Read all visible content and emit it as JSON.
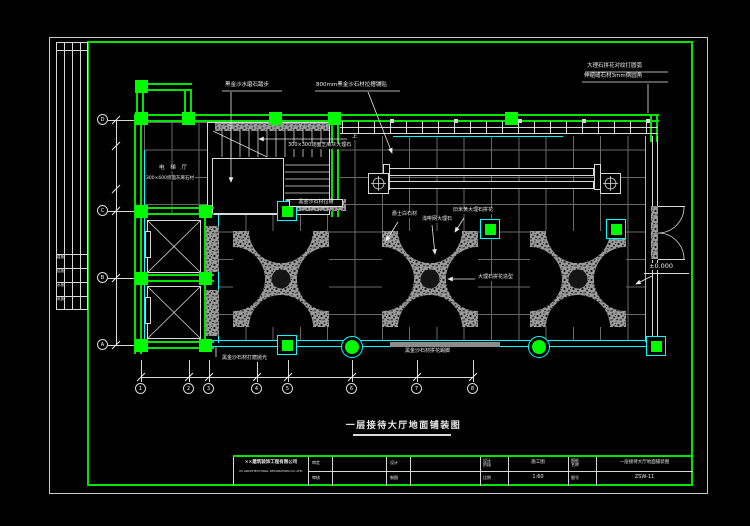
{
  "plan": {
    "title": "一层接待大厅地面铺装图",
    "notes": {
      "step": "黑金沙水磨石踏步",
      "base": "800mm黑金沙石材拉槽铺贴",
      "corner1": "大理石拼花对纹打圆弧",
      "corner2": "伸缩缝石材3mm倒圆角",
      "stair_stone": "300×300烧面芝麻灰大理石",
      "up": "上",
      "elev_hall": "电 梯 厅",
      "elev_floor": "300×600烧面灰麻石材",
      "groove": "黑金沙石材拉槽",
      "white_stone": "爵士白石材",
      "coffee_stone": "浅啡网大理石",
      "beige_stone": "旧米黄大理石拼花",
      "medallion": "大理石拼花造型",
      "polish": "黑金沙石材打磨抛光",
      "skirt": "黑金沙石材拼花踢脚",
      "level": "±0.000"
    },
    "grid": {
      "rows": [
        "D",
        "C",
        "B",
        "A"
      ],
      "cols": [
        "1",
        "2",
        "3",
        "4",
        "5",
        "6",
        "7",
        "8"
      ]
    }
  },
  "titleblock": {
    "company1": "××建筑装饰工程有限公司",
    "company2": "XX ARCHITECTURAL DECORATION CO.,LTD.",
    "l_shending": "审定",
    "l_shenhe": "审核",
    "l_sheji": "设计",
    "l_zhitu": "制图",
    "l_stage": "设计阶段",
    "v_stage": "施工图",
    "l_scale": "比例",
    "v_scale": "1:60",
    "l_name": "图纸名称",
    "v_name": "一层接待大厅地面铺装图",
    "l_no": "图号",
    "v_no": "ZSW-11"
  },
  "signstrip": {
    "rows": [
      "建施",
      "结施",
      "水施",
      "电施"
    ]
  },
  "colors": {
    "frame_green": "#00e400",
    "finish_cyan": "#00ffff",
    "grid_gray": "#686868",
    "stone_gray": "#9b9b9b"
  }
}
